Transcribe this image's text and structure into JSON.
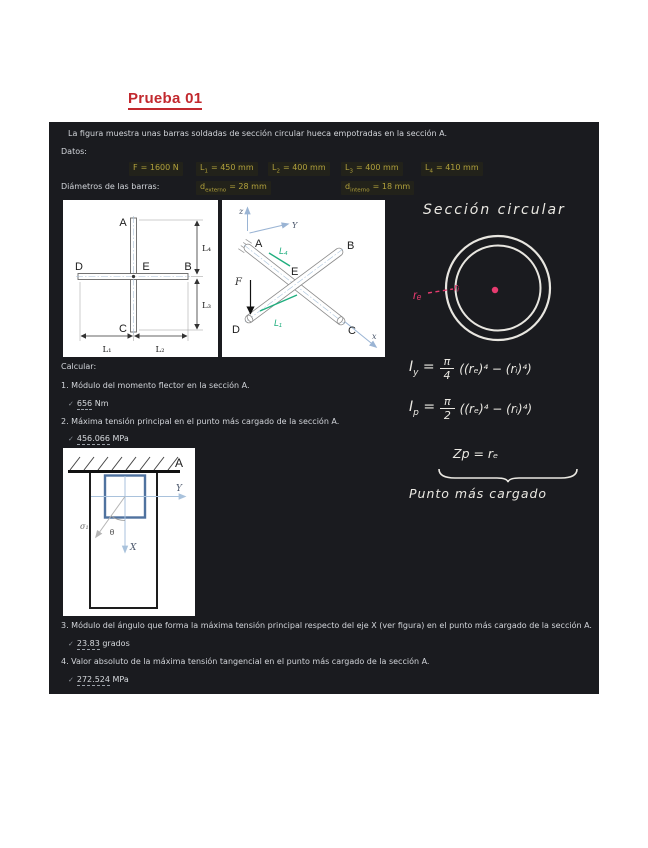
{
  "page": {
    "title": "Prueba 01"
  },
  "panel": {
    "intro": "La figura muestra unas barras soldadas de sección circular hueca empotradas en la sección A.",
    "datos_label": "Datos:",
    "datos": [
      {
        "base": "F",
        "sub": "",
        "rest": "= 1600 N"
      },
      {
        "base": "L",
        "sub": "1",
        "rest": "= 450 mm"
      },
      {
        "base": "L",
        "sub": "2",
        "rest": "= 400 mm"
      },
      {
        "base": "L",
        "sub": "3",
        "rest": "= 400 mm"
      },
      {
        "base": "L",
        "sub": "4",
        "rest": "= 410 mm"
      }
    ],
    "diametros_label": "Diámetros de las barras:",
    "diametros": [
      {
        "base": "d",
        "sub": "externo",
        "rest": "= 28 mm"
      },
      {
        "base": "d",
        "sub": "interno",
        "rest": "= 18 mm"
      }
    ],
    "calcular_label": "Calcular:",
    "check_glyph": "✓",
    "questions": [
      {
        "text": "1. Módulo del momento flector en la sección A.",
        "answer": "656",
        "unit": "Nm"
      },
      {
        "text": "2. Máxima tensión principal en el punto más cargado de la sección A.",
        "answer": "456.066",
        "unit": "MPa"
      },
      {
        "text": "3. Módulo del ángulo que forma la máxima tensión principal respecto del eje X (ver figura) en el punto más cargado de la sección A.",
        "answer": "23.83",
        "unit": "grados"
      },
      {
        "text": "4. Valor absoluto de la máxima tensión tangencial en el punto más cargado de la sección A.",
        "answer": "272.524",
        "unit": "MPa"
      }
    ]
  },
  "fig_plan": {
    "labels": {
      "A": "A",
      "B": "B",
      "C": "C",
      "D": "D",
      "E": "E",
      "L1": "L₁",
      "L2": "L₂",
      "L3": "L₃",
      "L4": "L₄"
    }
  },
  "fig_iso": {
    "labels": {
      "z": "z",
      "Y": "Y",
      "x": "x",
      "A": "A",
      "B": "B",
      "C": "C",
      "D": "D",
      "E": "E",
      "F": "F",
      "L1": "L₁",
      "L4": "L₄"
    }
  },
  "fig_section": {
    "labels": {
      "A": "A",
      "X": "X",
      "Y": "Y",
      "theta": "θ",
      "sigma1": "σ₁"
    }
  },
  "notes": {
    "heading": "Sección circular",
    "re": "rₑ",
    "ri": "rᵢ",
    "iy": {
      "base": "I",
      "sub": "y",
      "eq": "=",
      "num": "π",
      "den": "4",
      "rhs": "((rₑ)⁴ − (rᵢ)⁴)"
    },
    "ip": {
      "base": "I",
      "sub": "p",
      "eq": "=",
      "num": "π",
      "den": "2",
      "rhs": "((rₑ)⁴ − (rᵢ)⁴)"
    },
    "zp": "Zp =  rₑ",
    "caption": "Punto más cargado"
  },
  "colors": {
    "accent_red": "#c2292e",
    "value_yellow": "#b1a13c",
    "pink": "#e63b6f",
    "green": "#1fae7e",
    "panel_bg": "#1a1b1f"
  }
}
